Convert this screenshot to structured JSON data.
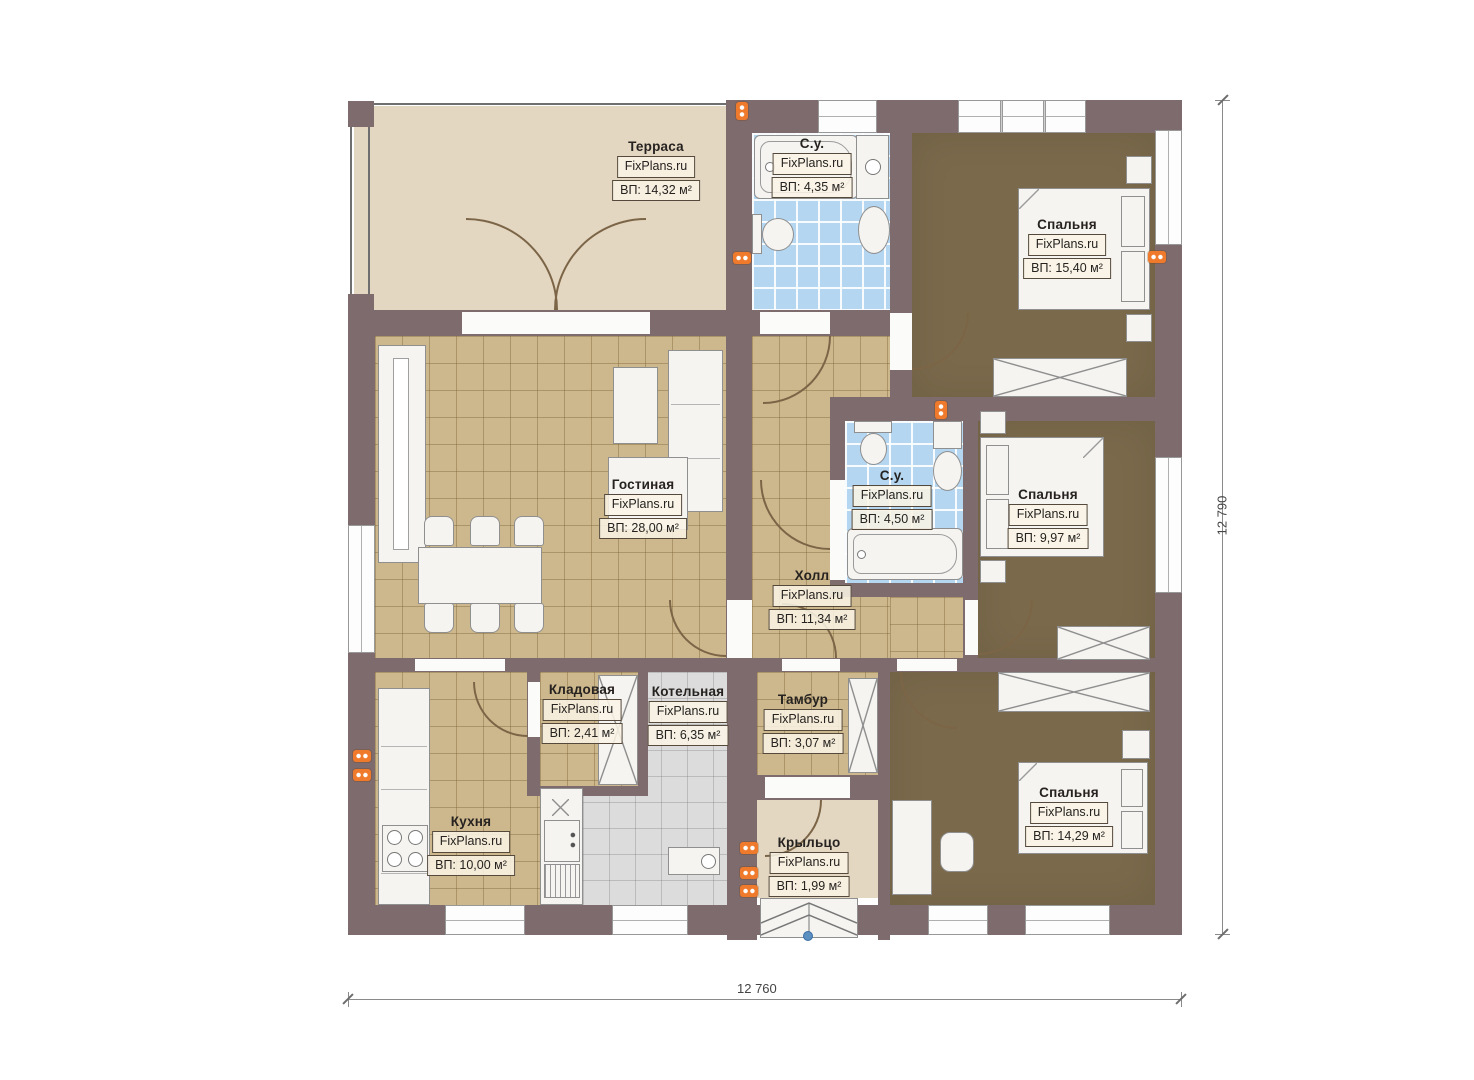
{
  "watermark": "FixPlans.ru",
  "rooms": [
    {
      "name": "Терраса",
      "area": "ВП: 14,32 м²"
    },
    {
      "name": "С.у.",
      "area": "ВП: 4,35 м²"
    },
    {
      "name": "Спальня",
      "area": "ВП: 15,40 м²"
    },
    {
      "name": "Гостиная",
      "area": "ВП: 28,00 м²"
    },
    {
      "name": "С.у.",
      "area": "ВП: 4,50 м²"
    },
    {
      "name": "Спальня",
      "area": "ВП: 9,97 м²"
    },
    {
      "name": "Холл",
      "area": "ВП: 11,34 м²"
    },
    {
      "name": "Кладовая",
      "area": "ВП: 2,41 м²"
    },
    {
      "name": "Котельная",
      "area": "ВП: 6,35 м²"
    },
    {
      "name": "Тамбур",
      "area": "ВП: 3,07 м²"
    },
    {
      "name": "Кухня",
      "area": "ВП: 10,00 м²"
    },
    {
      "name": "Крыльцо",
      "area": "ВП: 1,99 м²"
    },
    {
      "name": "Спальня",
      "area": "ВП: 14,29 м²"
    }
  ],
  "dimensions": {
    "bottom": "12 760",
    "right": "12 790"
  },
  "colors": {
    "wall": "#7d6b6e",
    "tile_floor": "#cdb88d",
    "wood_floor": "#7a694b",
    "bath_floor": "#b4d6f0",
    "terrace_floor": "#e3d7c2",
    "boiler_floor": "#dcdcdc",
    "outlet": "#f07a2b",
    "entry_marker": "#5b8fc0"
  }
}
